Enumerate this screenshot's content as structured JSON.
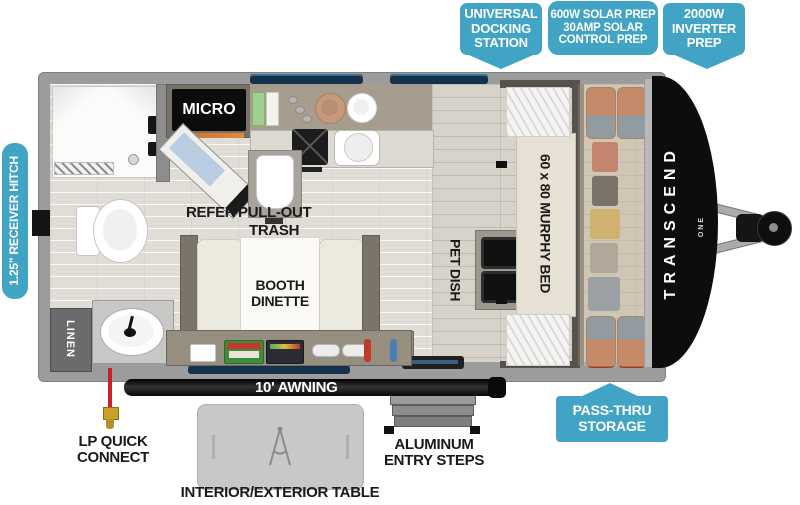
{
  "colors": {
    "callout_blue": "#42a4c5",
    "label_black": "#1a1a1a",
    "wall_gray": "#9c9c9c",
    "cap_black": "#0d0d0d",
    "lp_line_red": "#cc2027"
  },
  "callouts": {
    "docking": {
      "l1": "UNIVERSAL",
      "l2": "DOCKING",
      "l3": "STATION"
    },
    "solar": {
      "l1": "600W SOLAR PREP",
      "l2": "30AMP SOLAR",
      "l3": "CONTROL PREP"
    },
    "inverter": {
      "l1": "2000W",
      "l2": "INVERTER",
      "l3": "PREP"
    },
    "receiver_hitch": "1.25\" RECEIVER HITCH",
    "pass_thru": {
      "l1": "PASS-THRU",
      "l2": "STORAGE"
    }
  },
  "floorplan": {
    "micro": "MICRO",
    "refer": "REFER",
    "pull_out": "PULL-OUT",
    "trash": "TRASH",
    "booth": {
      "l1": "BOOTH",
      "l2": "DINETTE"
    },
    "pet_dish": "PET DISH",
    "murphy_bed": "60 x 80 MURPHY BED",
    "linen": "LINEN",
    "awning": "10' AWNING",
    "brand": "TRANSCEND",
    "brand_sub": "ONE"
  },
  "exterior": {
    "lp": {
      "l1": "LP QUICK",
      "l2": "CONNECT"
    },
    "table": "INTERIOR/EXTERIOR TABLE",
    "steps": {
      "l1": "ALUMINUM",
      "l2": "ENTRY STEPS"
    }
  }
}
